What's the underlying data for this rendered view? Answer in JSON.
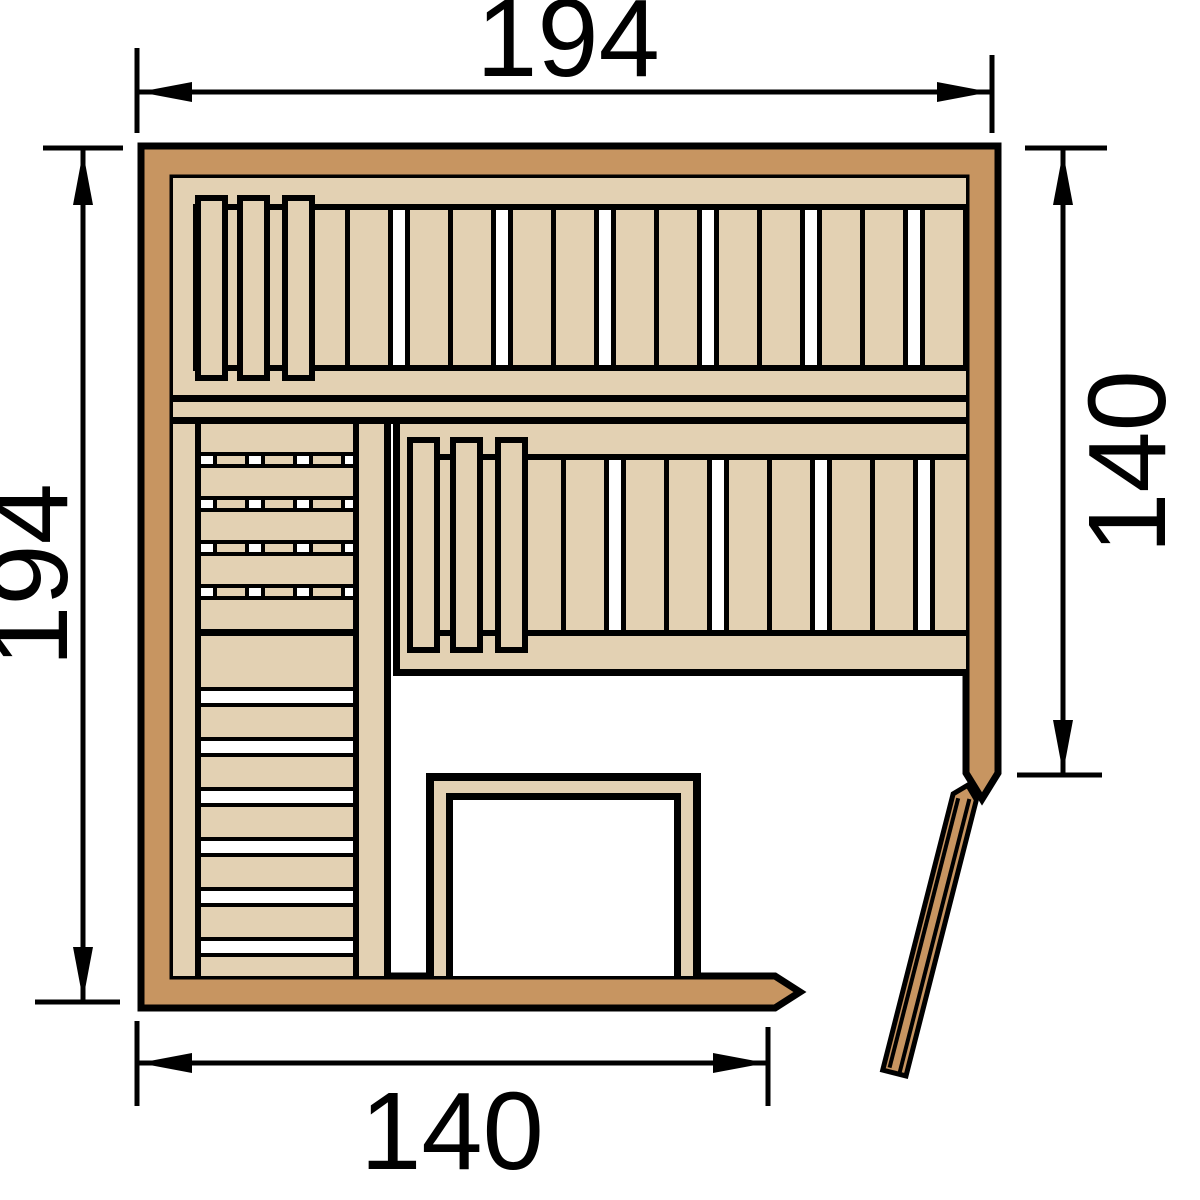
{
  "diagram": {
    "type": "sauna-floor-plan",
    "dimensions": {
      "top": {
        "label": "194"
      },
      "left": {
        "label": "194"
      },
      "right": {
        "label": "140"
      },
      "bottom": {
        "label": "140"
      }
    },
    "colors": {
      "wall_wood": "#c79561",
      "bench_wood": "#e3d1b3",
      "outline": "#000000",
      "background": "#ffffff"
    }
  }
}
